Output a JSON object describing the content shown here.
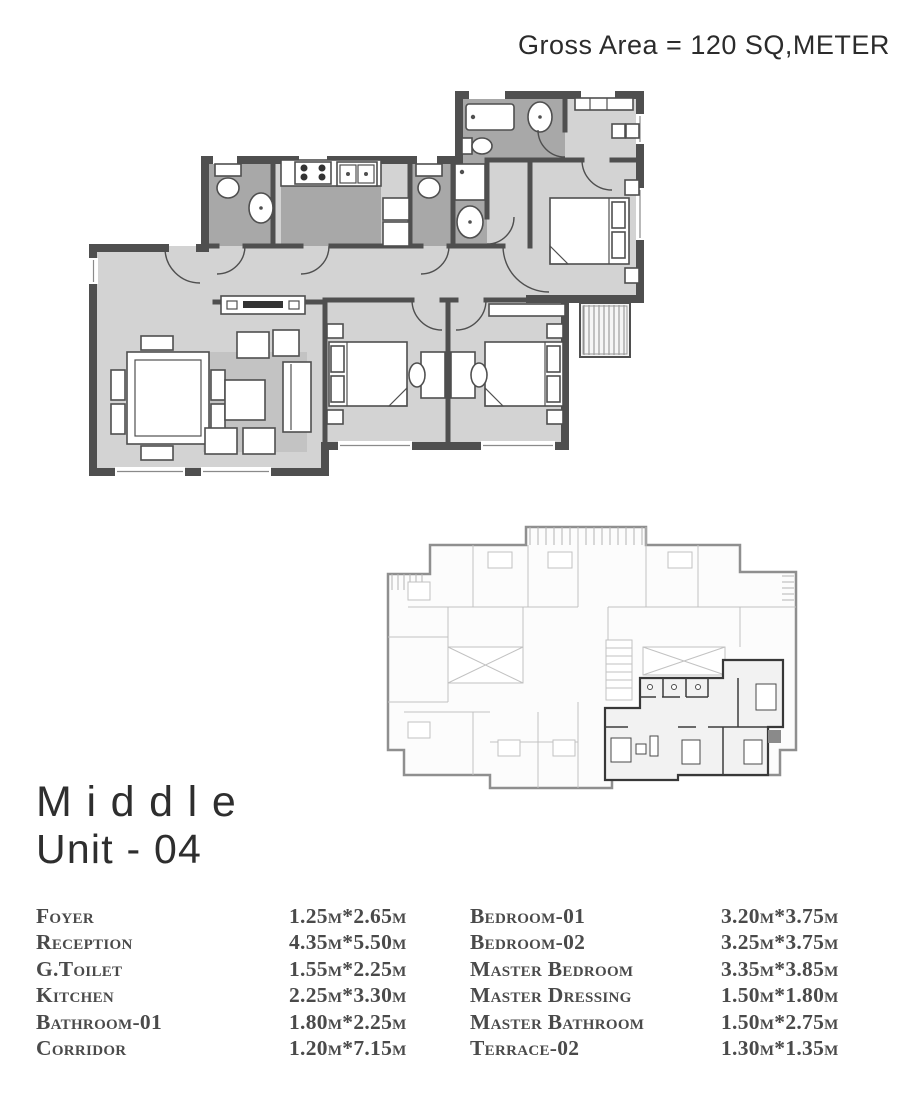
{
  "header": {
    "gross_area_label": "Gross Area = 120 SQ,METER"
  },
  "unit_title": {
    "line1": "Middle",
    "line2": "Unit - 04"
  },
  "room_dimensions": {
    "left_column": [
      {
        "room": "Foyer",
        "size": "1.25m*2.65m"
      },
      {
        "room": "Reception",
        "size": "4.35m*5.50m"
      },
      {
        "room": "G.Toilet",
        "size": "1.55m*2.25m"
      },
      {
        "room": "Kitchen",
        "size": "2.25m*3.30m"
      },
      {
        "room": "Bathroom-01",
        "size": "1.80m*2.25m"
      },
      {
        "room": "Corridor",
        "size": "1.20m*7.15m"
      }
    ],
    "right_column": [
      {
        "room": "Bedroom-01",
        "size": "3.20m*3.75m"
      },
      {
        "room": "Bedroom-02",
        "size": "3.25m*3.75m"
      },
      {
        "room": "Master Bedroom",
        "size": "3.35m*3.85m"
      },
      {
        "room": "Master Dressing",
        "size": "1.50m*1.80m"
      },
      {
        "room": "Master Bathroom",
        "size": "1.50m*2.75m"
      },
      {
        "room": "Terrace-02",
        "size": "1.30m*1.35m"
      }
    ]
  },
  "colors": {
    "wall": "#4f4f4f",
    "floor": "#d3d3d3",
    "bath_tile": "#a8a8a8",
    "rug": "#c3c3c3",
    "text": "#2e2e2e",
    "table_text": "#4a4a4a",
    "keyplan_light": "#c2c2c2",
    "keyplan_highlight": "#383838"
  }
}
